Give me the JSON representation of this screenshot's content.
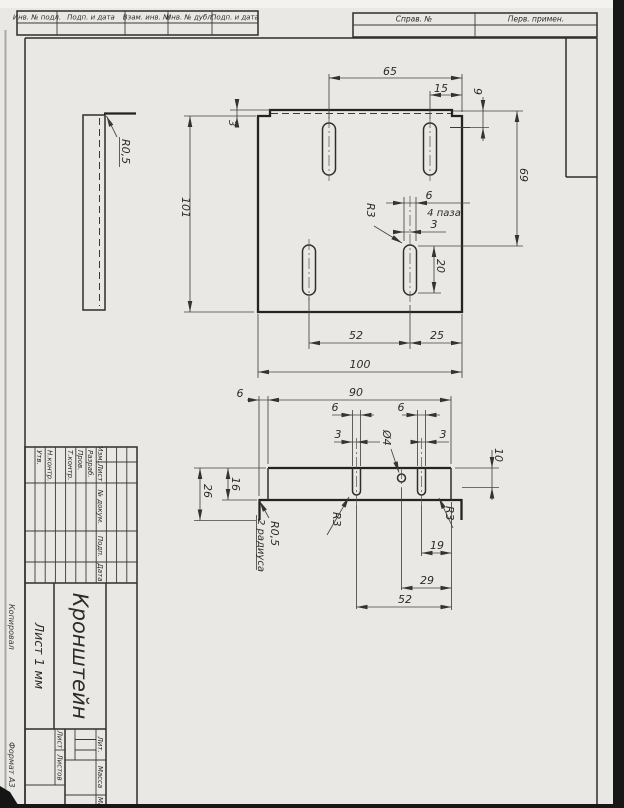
{
  "margin_strips": {
    "inv_podl": "Инв. № подл.",
    "podp_data_1": "Подп. и дата",
    "vzam_inv": "Взам. инв. №",
    "inv_dubl": "Инв. № дубл.",
    "podp_data_2": "Подп. и дата",
    "sprav_no": "Справ. №",
    "perv_primen": "Перв. примен."
  },
  "front_view": {
    "width_top": "65",
    "offset_right": "15",
    "depth_right": "9",
    "step_height": "3",
    "height_total": "101",
    "height_right": "69",
    "slot_width": "6",
    "slot_note": "4 паза",
    "slot_half_width": "3",
    "slot_radius": "R3",
    "slot_length": "20",
    "slot_spacing": "52",
    "slot_to_edge": "25",
    "width_total": "100"
  },
  "side_view": {
    "bend_radius": "R0,5"
  },
  "bottom_view": {
    "offset_left": "6",
    "flange_width": "90",
    "slot_a_width": "6",
    "slot_b_width": "6",
    "slot_a_half": "3",
    "slot_b_half": "3",
    "hole_diameter": "Ø4",
    "flange_height": "10",
    "height_inner": "16",
    "height_outer": "26",
    "bend_radius": "R0,5",
    "radius_note": "2 радиуса",
    "slot_a_radius": "R3",
    "slot_b_radius": "R3",
    "dim_19": "19",
    "dim_29": "29",
    "dim_52": "52"
  },
  "title_block": {
    "header": {
      "izm": "Изм.",
      "list": "Лист",
      "dokum": "№ докум.",
      "podp": "Подп.",
      "data": "Дата"
    },
    "rows": {
      "razrab": "Разраб.",
      "prov": "Пров.",
      "tkontr": "Т.контр.",
      "nkontr": "Н.контр.",
      "utv": "Утв."
    },
    "name": "Кронштейн",
    "material": "Лист 1 мм",
    "lit": "Лит.",
    "massa": "Масса",
    "masshtab": "Масштаб",
    "list": "Лист",
    "listov": "Листов"
  },
  "margin_notes": {
    "kopiroval": "Копировал",
    "format": "Формат А3"
  }
}
